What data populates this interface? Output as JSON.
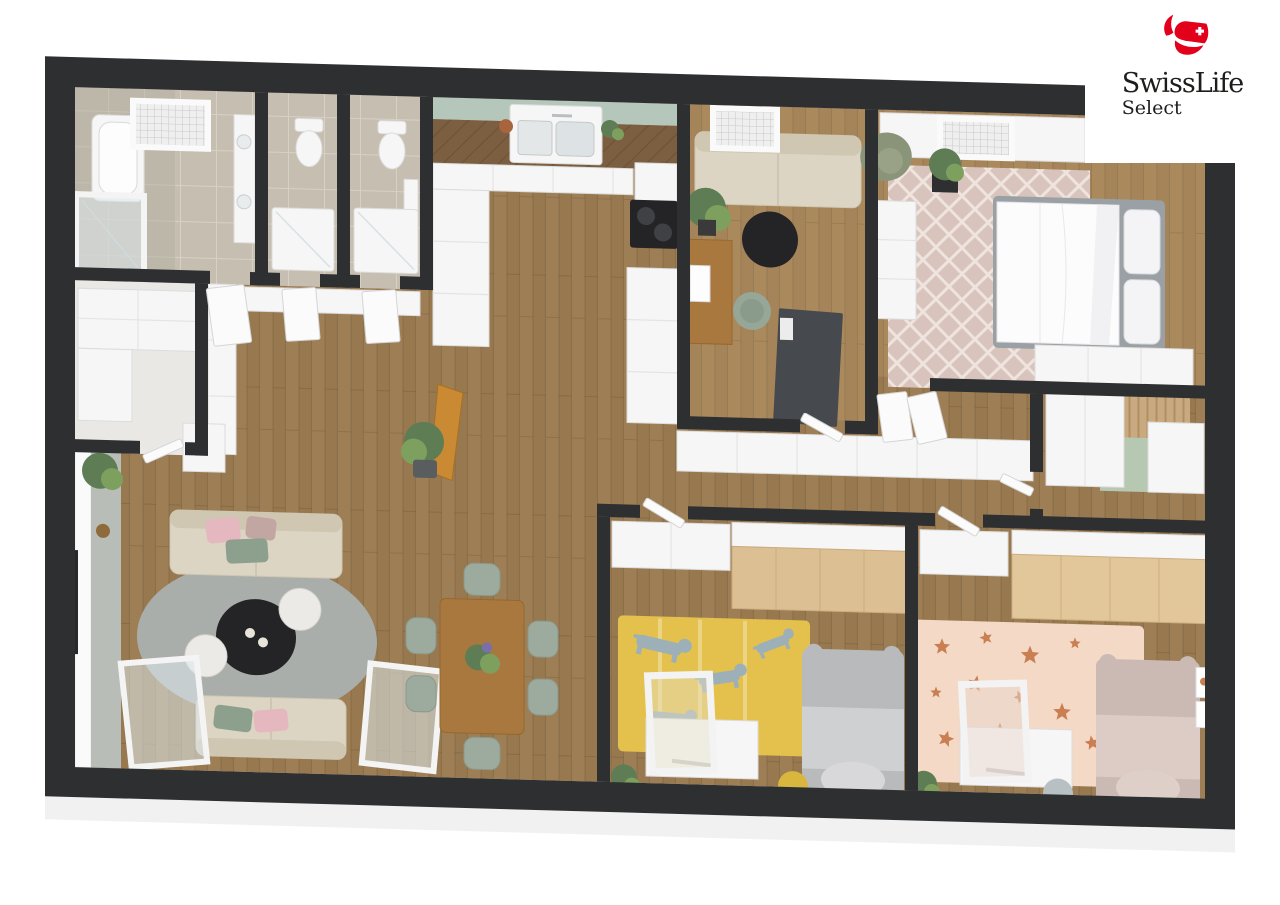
{
  "logo": {
    "brand": "SwissLife",
    "product": "Select"
  },
  "colors": {
    "pageBg": "#ffffff",
    "brandRed": "#e2001a",
    "logoText": "#1d1d1b",
    "wallDark": "#2e2f31",
    "slab": "#f1f1f1",
    "floorWood": "#97784f",
    "floorWoodLight": "#a58459",
    "kitchenCounterWood": "#7c5f41",
    "tile": "#c6beb0",
    "tileGrout": "#d7d0c4",
    "tileGray": "#b2afa5",
    "backsplashGreen": "#b5c6ba",
    "furnitureWhite": "#f6f6f6",
    "furnitureWhiteEdge": "#dcdcdc",
    "sofaBeige": "#ddd5c3",
    "sofaBeigeDark": "#d0c7b2",
    "pillowPink": "#e5b7be",
    "pillowGreen": "#8da08d",
    "pillowMauve": "#c2a6a2",
    "rugLivingGray": "#a9aeab",
    "rugBedroom": "#d9c4bd",
    "rugBedroomLine": "#efe4de",
    "rugKidsYellow": "#e4c14d",
    "rugKidsPink": "#f3d9c6",
    "starOrange": "#c97f52",
    "dogGray": "#9db0b8",
    "tableBlack": "#242427",
    "woodFurniture": "#a8783f",
    "woodWardrobe": "#dcc094",
    "chairSage": "#9cab9e",
    "plantGreen": "#5e7d54",
    "plantGreenLight": "#7da05e",
    "bedGray": "#b9babc",
    "bedGrayLight": "#cfd0d2",
    "bedPink": "#cbbab3",
    "bedPinkLight": "#dcccc5",
    "rugStudyDark": "#46494d",
    "matGreen": "#b7c8b2",
    "glassBlue": "#dfe9ec",
    "poufYellow": "#d9b63e",
    "poufGray": "#b9c0c4",
    "tvBlack": "#26292d",
    "mediaGray": "#b8bdb8",
    "mirrorGray": "#8b9094"
  }
}
